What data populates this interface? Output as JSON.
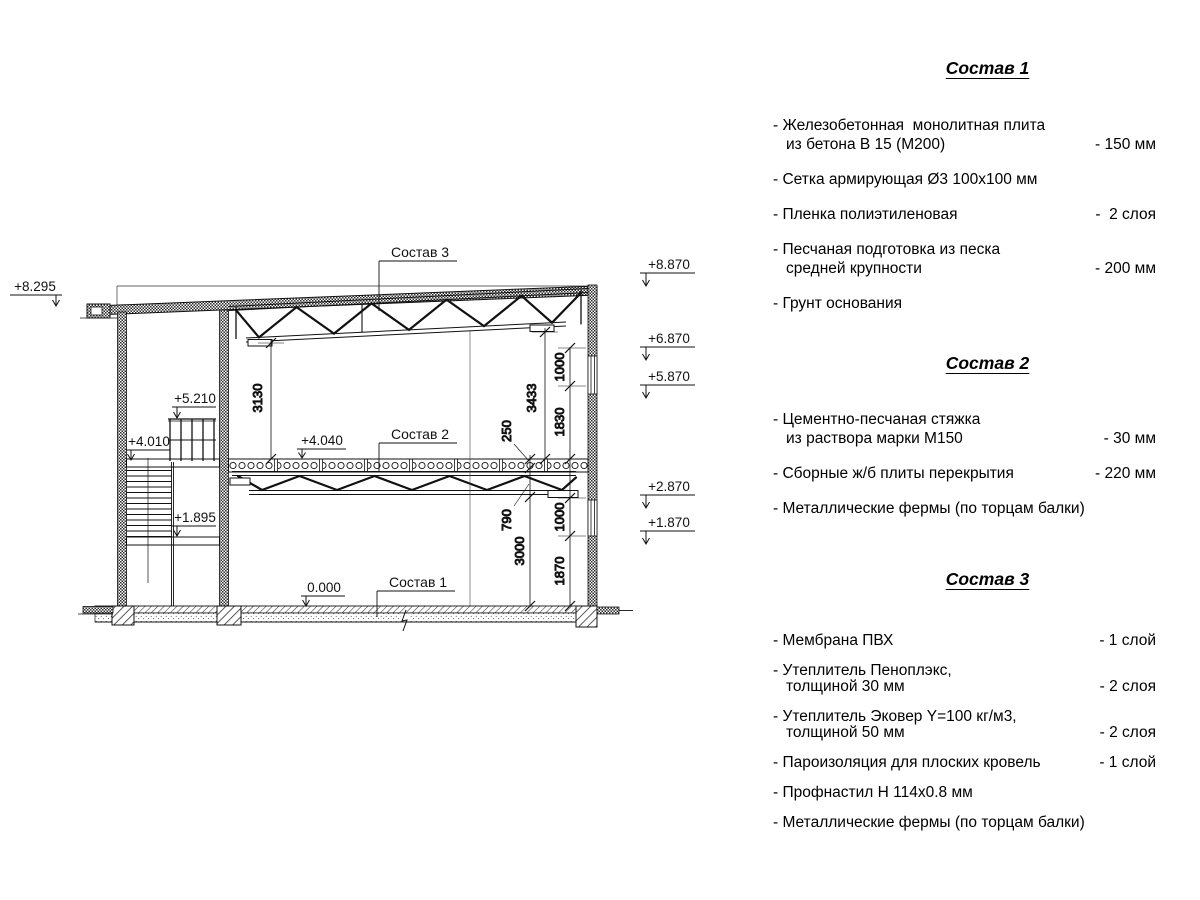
{
  "drawing": {
    "elevations": {
      "m8295": "+8.295",
      "m5210": "+5.210",
      "m4010": "+4.010",
      "m1895": "+1.895",
      "m4040": "+4.040",
      "m0": "0.000",
      "m8870": "+8.870",
      "m6870": "+6.870",
      "m5870": "+5.870",
      "m2870": "+2.870",
      "m1870": "+1.870"
    },
    "dims": {
      "h3130": "3130",
      "h3433": "3433",
      "s250": "250",
      "s790": "790",
      "s3000": "3000",
      "u1000": "1000",
      "u1830": "1830",
      "l1000": "1000",
      "l1870": "1870"
    },
    "labels": {
      "c1": "Состав 1",
      "c2": "Состав 2",
      "c3": "Состав 3"
    }
  },
  "specs": [
    {
      "title": "Состав 1",
      "items": [
        {
          "lines": [
            "- Железобетонная  монолитная плита",
            "из бетона В 15 (М200)"
          ],
          "value": "- 150 мм"
        },
        {
          "lines": [
            "- Сетка армирующая Ø3 100х100 мм"
          ],
          "value": ""
        },
        {
          "lines": [
            "- Пленка полиэтиленовая"
          ],
          "value": "-  2 слоя"
        },
        {
          "lines": [
            "- Песчаная подготовка из песка",
            "средней крупности"
          ],
          "value": "- 200 мм"
        },
        {
          "lines": [
            "- Грунт основания"
          ],
          "value": ""
        }
      ]
    },
    {
      "title": "Состав 2",
      "items": [
        {
          "lines": [
            "- Цементно-песчаная стяжка",
            "из раствора марки М150"
          ],
          "value": "- 30 мм"
        },
        {
          "lines": [
            "- Сборные ж/б плиты перекрытия"
          ],
          "value": "- 220 мм"
        },
        {
          "lines": [
            "- Металлические фермы (по торцам балки)"
          ],
          "value": ""
        }
      ]
    },
    {
      "title": "Состав 3",
      "items": [
        {
          "lines": [
            "- Мембрана ПВХ"
          ],
          "value": "- 1 слой"
        },
        {
          "lines": [
            "- Утеплитель Пеноплэкс,",
            "толщиной 30 мм"
          ],
          "value": "- 2 слоя"
        },
        {
          "lines": [
            "- Утеплитель Эковер Y=100 кг/м3,",
            "толщиной 50 мм"
          ],
          "value": "- 2 слоя"
        },
        {
          "lines": [
            "- Пароизоляция для плоских кровель"
          ],
          "value": "- 1 слой"
        },
        {
          "lines": [
            "- Профнастил Н 114х0.8 мм"
          ],
          "value": ""
        },
        {
          "lines": [
            "- Металлические фермы (по торцам балки)"
          ],
          "value": ""
        }
      ]
    }
  ]
}
